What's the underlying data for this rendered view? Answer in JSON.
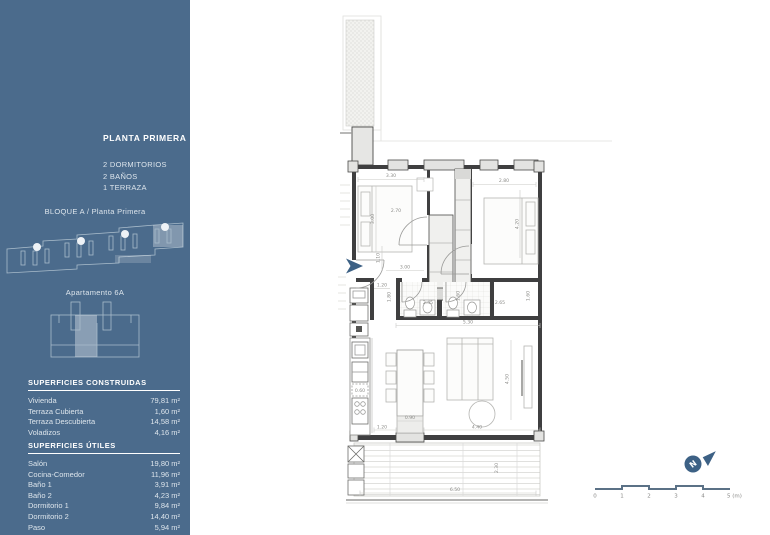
{
  "sidebar": {
    "title": "PLANTA PRIMERA",
    "features": [
      "2 DORMITORIOS",
      "2 BAÑOS",
      "1 TERRAZA"
    ],
    "block_label": "BLOQUE A / Planta Primera",
    "apartment_label": "Apartamento 6A",
    "built_areas": {
      "header": "SUPERFICIES CONSTRUIDAS",
      "rows": [
        {
          "label": "Vivienda",
          "value": "79,81 m²"
        },
        {
          "label": "Terraza Cubierta",
          "value": "1,60 m²"
        },
        {
          "label": "Terraza Descubierta",
          "value": "14,58 m²"
        },
        {
          "label": "Voladizos",
          "value": "4,16 m²"
        }
      ]
    },
    "useful_areas": {
      "header": "SUPERFICIES ÚTILES",
      "rows": [
        {
          "label": "Salón",
          "value": "19,80 m²"
        },
        {
          "label": "Cocina-Comedor",
          "value": "11,96 m²"
        },
        {
          "label": "Baño 1",
          "value": "3,91 m²"
        },
        {
          "label": "Baño 2",
          "value": "4,23 m²"
        },
        {
          "label": "Dormitorio 1",
          "value": "9,84 m²"
        },
        {
          "label": "Dormitorio 2",
          "value": "14,40 m²"
        },
        {
          "label": "Paso",
          "value": "5,94 m²"
        }
      ]
    }
  },
  "plan": {
    "dims": {
      "d330": "3.30",
      "d300v": "3.00",
      "d270": "2.70",
      "d280": "2.80",
      "d420": "4.20",
      "d110": "1.10",
      "d300h": "3.00",
      "d120a": "1.20",
      "d180": "1.80",
      "d245": "2.45",
      "d160a": "1.60",
      "d265": "2.65",
      "d160b": "1.60",
      "d530": "5.30",
      "d060": "0.60",
      "d090": "0.90",
      "d120b": "1.20",
      "d440": "4.40",
      "d450": "4.50",
      "d650": "6.50",
      "d230": "2.30"
    }
  },
  "scale_bar": {
    "labels": [
      "0",
      "1",
      "2",
      "3",
      "4",
      "5 (m)"
    ]
  },
  "north_icon": {
    "letter": "N"
  },
  "colors": {
    "sidebar": "#4b6b8c",
    "accent": "#3d6185",
    "wall": "#3f3f40"
  }
}
